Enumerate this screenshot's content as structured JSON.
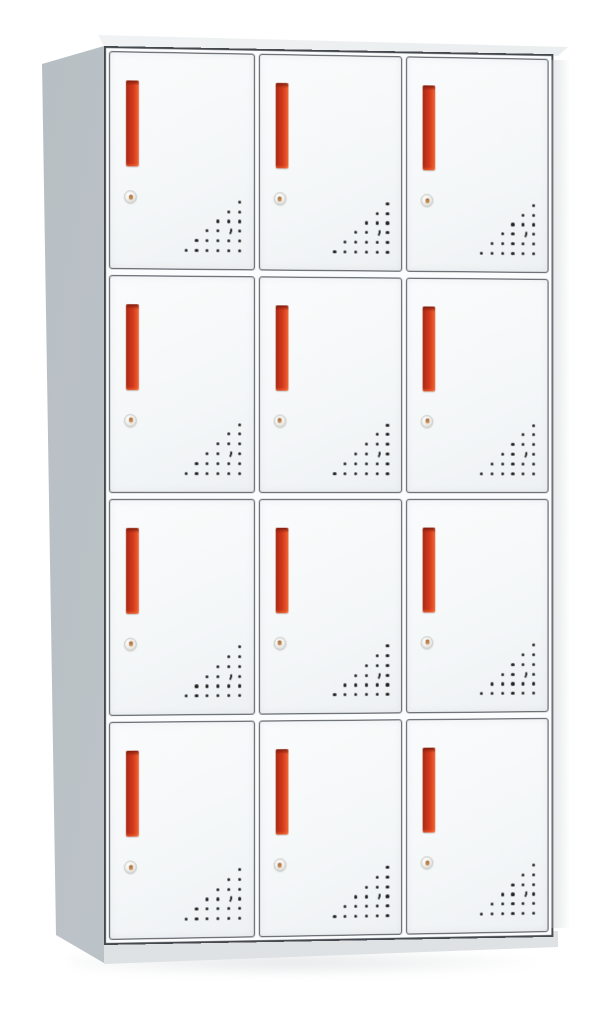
{
  "scene": {
    "type": "product-photo",
    "subject": "twelve-door metal locker cabinet, front-left perspective view",
    "background": "#ffffff"
  },
  "cabinet": {
    "rows": 4,
    "columns": 3,
    "door_count": 12,
    "features_per_door": [
      "red-recessed-handle",
      "round-cam-lock",
      "triangular-vent-holes"
    ],
    "colors": {
      "background": "#ffffff",
      "front_frame": "#fbfcfd",
      "door_face_top": "#fafbfc",
      "door_face_bottom": "#eef1f3",
      "door_border": "#44494e",
      "handle_dark": "#9e2715",
      "handle_mid": "#d33a1b",
      "handle_light": "#ef6a38",
      "handle_cap": "#7e1d0e",
      "lock_ring": "#f1f0ec",
      "lock_border": "#c3c4c0",
      "lock_pin": "#c28a52",
      "vent_dot": "#232323",
      "side_panel": "#b7bec3",
      "side_panel_light": "#c5cbcf",
      "top_surface": "#f1f3f4",
      "base": "#e6e9ea"
    },
    "vent": {
      "grid_rows": 6,
      "grid_cols": 6,
      "crescent_row": 3,
      "crescent_col": 4,
      "cell_w": 10.8,
      "cell_h": 9.8
    }
  }
}
